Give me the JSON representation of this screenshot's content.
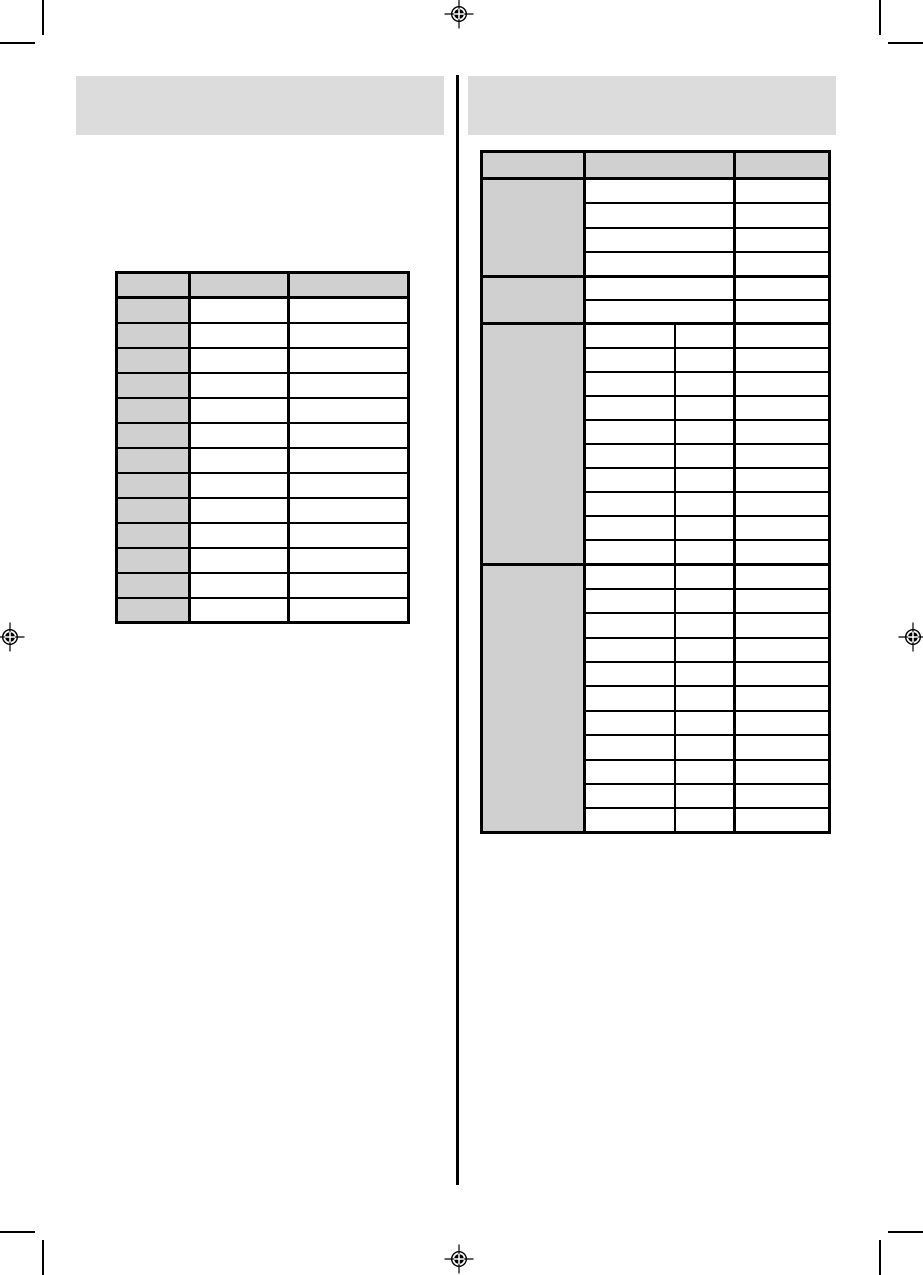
{
  "page": {
    "kind": "printed-manual-page-with-empty-tables",
    "background": "#ffffff"
  },
  "colors": {
    "header_bar_fill": "#dcdcdc",
    "table_header_fill": "#d0d0d0",
    "table_border": "#000000",
    "registration_mark": "#000000"
  },
  "header_bars": {
    "left": {
      "text": ""
    },
    "right": {
      "text": ""
    }
  },
  "left_table": {
    "header_cells": [
      "",
      "",
      ""
    ],
    "data_rows": 13,
    "row_cells": [
      "",
      "",
      ""
    ]
  },
  "right_table": {
    "header_cells": [
      "",
      "",
      ""
    ],
    "groups": [
      {
        "label": "",
        "rows": 4,
        "split_middle": false
      },
      {
        "label": "",
        "rows": 2,
        "split_middle": false
      },
      {
        "label": "",
        "rows": 10,
        "split_middle": true
      },
      {
        "label": "",
        "rows": 11,
        "split_middle": true
      }
    ]
  }
}
